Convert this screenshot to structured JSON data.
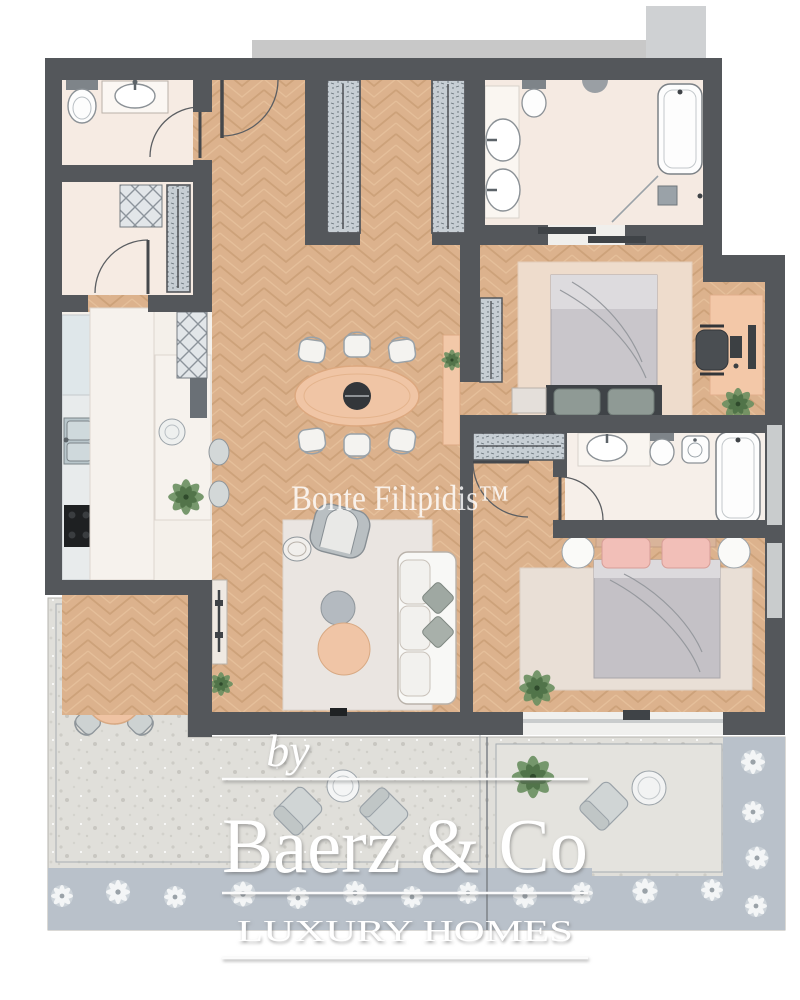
{
  "branding": {
    "watermark": "Bonte Filipidis™",
    "logo_prefix": "by",
    "logo_name": "Baerz & Co",
    "logo_tagline": "LUXURY HOMES"
  },
  "palette": {
    "wall": "#54575b",
    "wood_floor": "#dcb28d",
    "wood_line": "#c99b72",
    "bath_tile": "#f6ebe3",
    "kitchen_marble": "#f4f0ea",
    "terrace_paving": "#e0dfda",
    "planting_band": "#b9c1ca",
    "accent_peach": "#efc4a4",
    "furniture_gray": "#c6cdd2",
    "bed_duvet_gray": "#c6c3c8",
    "pink_pillow": "#f2bfb8",
    "plant_green": "#5f8457",
    "white_fixture": "#fbfbfa"
  }
}
